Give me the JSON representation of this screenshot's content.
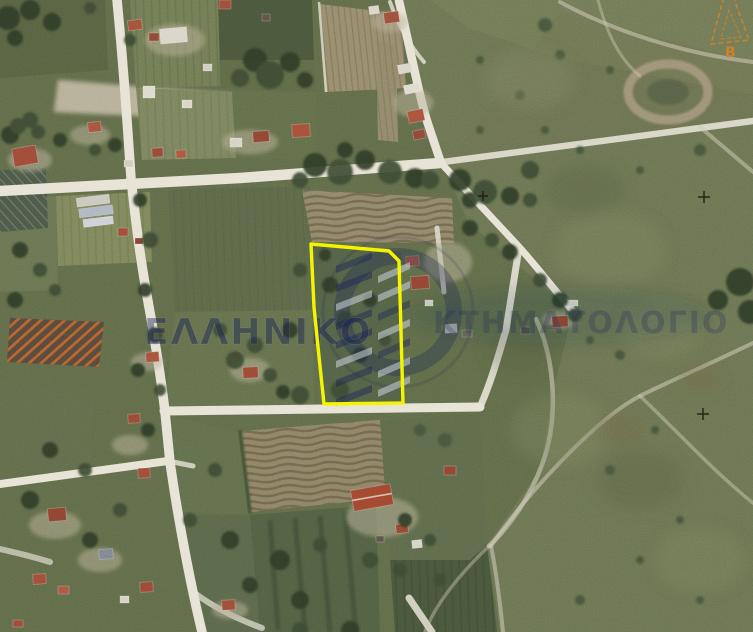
{
  "map": {
    "kind": "aerial-orthophoto",
    "watermark": {
      "left_text": "ΕΛΛΗΝΙΚΟ",
      "right_text": "ΚΤΗΜΑΤΟΛΟΓΙΟ",
      "text_color": "#1c2450"
    },
    "parcel": {
      "outline_color": "#f4f400"
    },
    "marker": {
      "label": "B",
      "color": "#c87a28"
    }
  }
}
